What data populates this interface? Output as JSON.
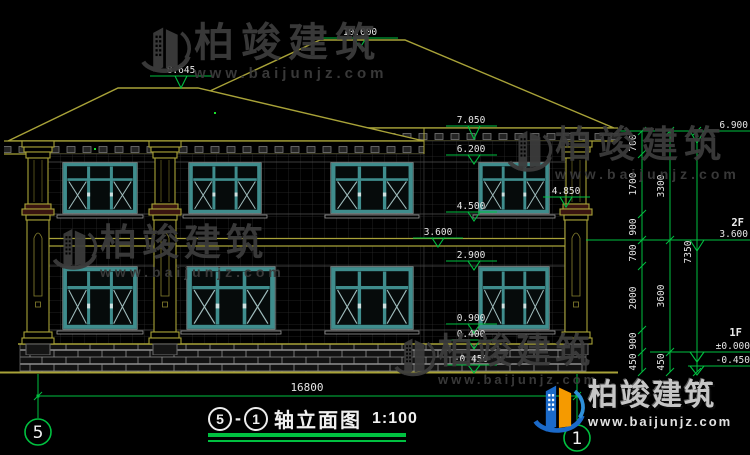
{
  "brand": {
    "name": "柏竣建筑",
    "url": "www.baijunjz.com"
  },
  "title": {
    "axis_left": "5",
    "sep": "-",
    "axis_right": "1",
    "text": "轴立面图",
    "scale": "1:100"
  },
  "bubbles": {
    "left": "5",
    "right": "1"
  },
  "levels": {
    "f2": "2F",
    "f1": "1F"
  },
  "elevations": {
    "ridge": "10.000",
    "left_ridge": "8.645",
    "left_eave": "7.050",
    "f2_win_top": "6.200",
    "col_capital": "4.850",
    "f2_win_sill": "4.500",
    "floor2": "3.600",
    "f1_win_top": "2.900",
    "f1_win_sill": "0.900",
    "plinth": "0.400",
    "ground": "-0.450",
    "right_eave": "6.900",
    "right_f2": "3.600",
    "right_zero": "±0.000",
    "right_ground": "-0.450"
  },
  "dims": {
    "total_width": "16800",
    "chain_a": [
      "700",
      "1700",
      "900",
      "700",
      "2000",
      "900",
      "450"
    ],
    "chain_b": [
      "3300",
      "3600",
      "450"
    ],
    "chain_c": [
      "7350"
    ]
  },
  "colors": {
    "background": "#000000",
    "cad_green": "#00c040",
    "cad_olive": "#a8a238",
    "window_teal": "#3f8d8d",
    "text_white": "#e6e6e6",
    "watermark_gray": "#3c3c3c",
    "logo_blue": "#1b6ac9",
    "logo_orange": "#f59a00"
  }
}
